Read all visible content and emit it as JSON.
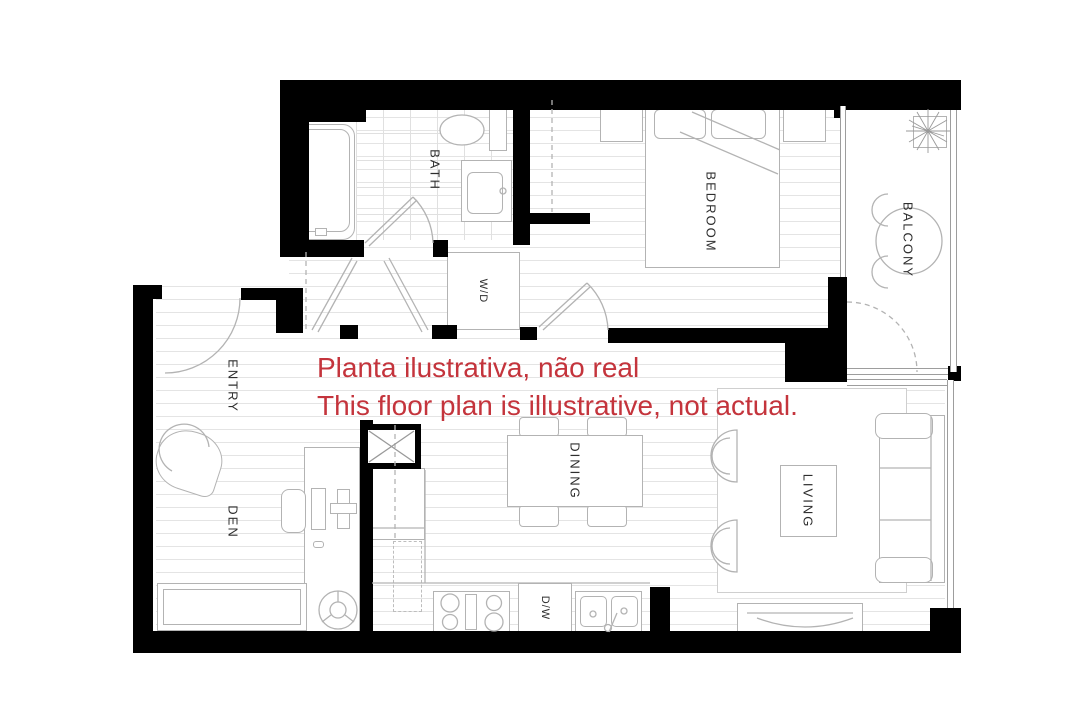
{
  "plan": {
    "rooms": {
      "bath": "BATH",
      "washer_dryer": "W/D",
      "bedroom": "BEDROOM",
      "balcony": "BALCONY",
      "entry": "ENTRY",
      "den": "DEN",
      "dining": "DINING",
      "living": "LIVING",
      "dishwasher": "D/W"
    },
    "annotation": {
      "line1": "Planta ilustrativa, não real",
      "line2": "This floor plan is illustrative, not actual."
    },
    "colors": {
      "annotation_red": "#c4343c",
      "wall_black": "#000000",
      "furniture_line": "#b3b3b3",
      "floor_line": "#e4e4e4"
    }
  }
}
